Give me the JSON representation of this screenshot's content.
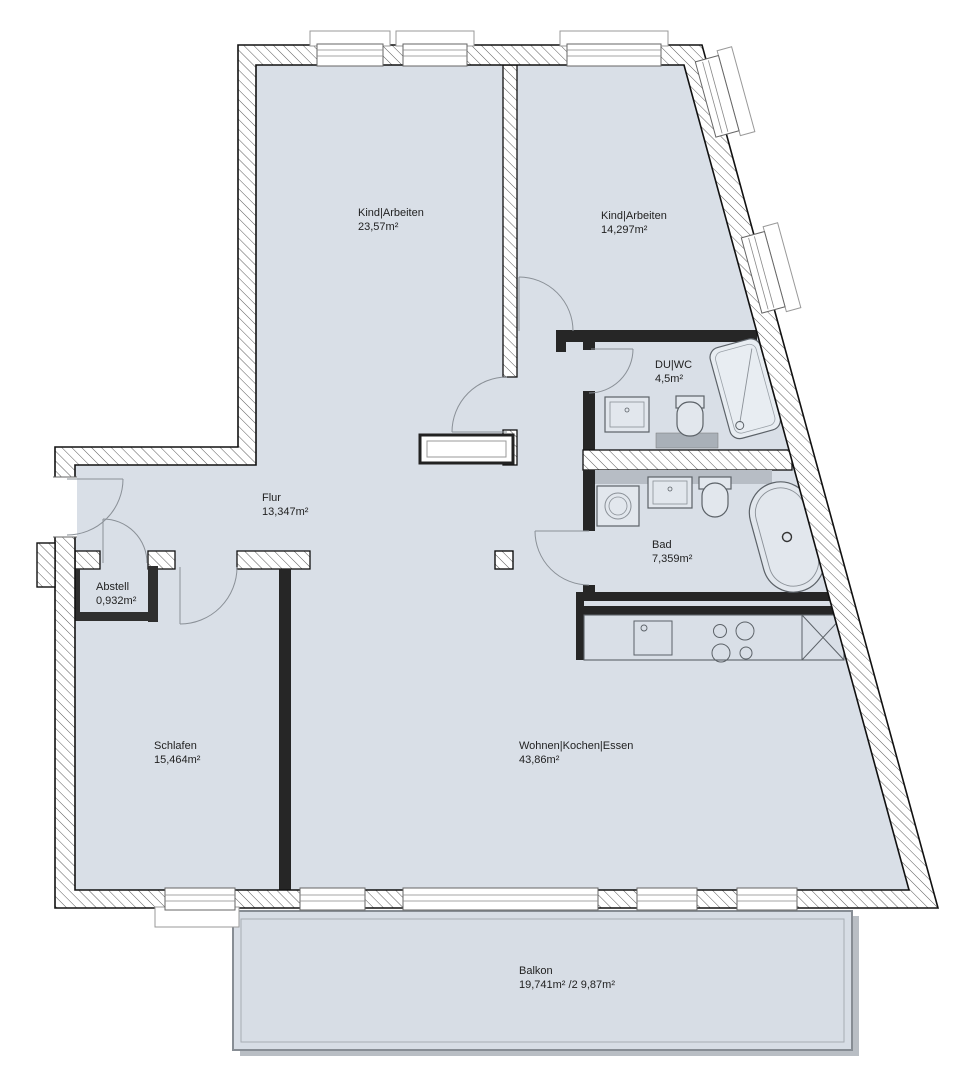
{
  "plan": {
    "type": "apartment-floorplan",
    "unit": "m²",
    "rooms": [
      {
        "name": "Kind|Arbeiten",
        "area": "23,57m²"
      },
      {
        "name": "Kind|Arbeiten",
        "area": "14,297m²"
      },
      {
        "name": "DU|WC",
        "area": "4,5m²"
      },
      {
        "name": "Flur",
        "area": "13,347m²"
      },
      {
        "name": "Abstell",
        "area": "0,932m²"
      },
      {
        "name": "Bad",
        "area": "7,359m²"
      },
      {
        "name": "Schlafen",
        "area": "15,464m²"
      },
      {
        "name": "Wohnen|Kochen|Essen",
        "area": "43,86m²"
      },
      {
        "name": "Balkon",
        "area": "19,741m² /2 9,87m²"
      }
    ],
    "colors": {
      "floor": "#d9dfe7",
      "balcony_floor": "#d7dde5",
      "wall_dark": "#262626",
      "wall_outline": "#111111",
      "hatch_line": "#5a5a5a",
      "door_arc": "#8a9097",
      "fixture_outline": "#5c6268",
      "fixture_fill": "#e2e7ed",
      "install_band": "#b7bdc5",
      "shadow": "#b9bec4"
    }
  }
}
